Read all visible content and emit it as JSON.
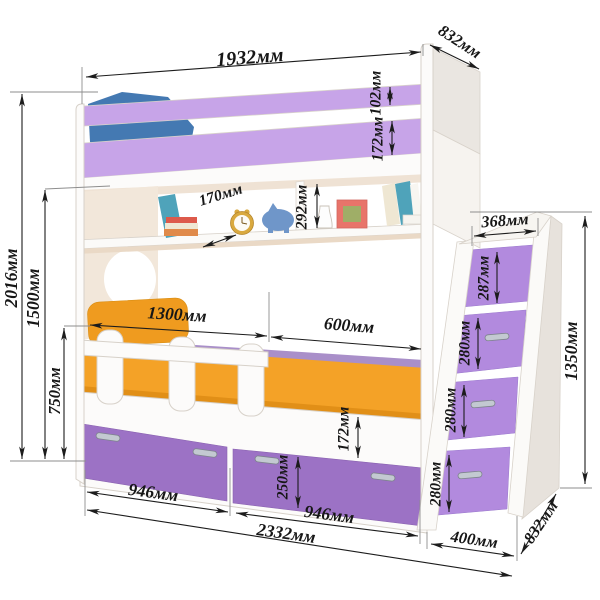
{
  "meta": {
    "type": "furniture-dimension-diagram",
    "subject": "bunk bed with shelf, drawers and storage stairs",
    "unit_suffix": "мм"
  },
  "dims": {
    "top_width": "1932мм",
    "top_depth": "832мм",
    "rail_upper": "102мм",
    "rail_lower": "172мм",
    "shelf_clearance": "292мм",
    "shelf_depth": "170мм",
    "overall_height": "2016мм",
    "underbunk_height": "1500мм",
    "lower_height": "750мм",
    "guard_length": "1300мм",
    "open_length": "600мм",
    "base_gap": "172мм",
    "drawer_height": "250мм",
    "drawer_left": "946мм",
    "drawer_right": "946мм",
    "overall_length": "2332мм",
    "step_width": "368мм",
    "step1": "287мм",
    "step2": "280мм",
    "step3": "280мм",
    "step4": "280мм",
    "stairs_height": "1350мм",
    "stairs_depth": "400мм",
    "stairs_side": "832мм"
  },
  "colors": {
    "background": "#ffffff",
    "rail_lilac": "#c7a4e8",
    "drawer_purple": "#9c72c5",
    "step_purple": "#b28ade",
    "back_band_purple": "#a98fc9",
    "mattress_orange": "#f4a227",
    "mattress_shadow": "#e18f17",
    "pillow_orange": "#ef9b1f",
    "pillow_blue": "#4479b2",
    "headboard_cream": "#f2e7da",
    "ceiling_cream": "#efe2d4",
    "shelf_edge_cream": "#ead9c6",
    "panel_shade": "#eae6e1",
    "stairs_side_shade": "#e7e2dc",
    "white_wood": "#fcfbfa",
    "dim_line": "#1c1c1c",
    "chrome_handle": "#c3c9d1",
    "frame_coral": "#e8746a",
    "frame_picture": "#9fae67",
    "clock_gold": "#d9a93f",
    "figurine_blue": "#6f96c9",
    "book_teal": "#4fa3ba",
    "book_red": "#dd5a4b",
    "book_cream": "#efe7d3",
    "book_orange": "#e08a4a"
  },
  "decor_items": [
    "blue-pillow",
    "orange-pillow",
    "guard-rail",
    "wall-shelf",
    "leaning-book",
    "book-stack",
    "alarm-clock",
    "piggy-bank",
    "vase",
    "picture-frame",
    "leaning-books"
  ]
}
